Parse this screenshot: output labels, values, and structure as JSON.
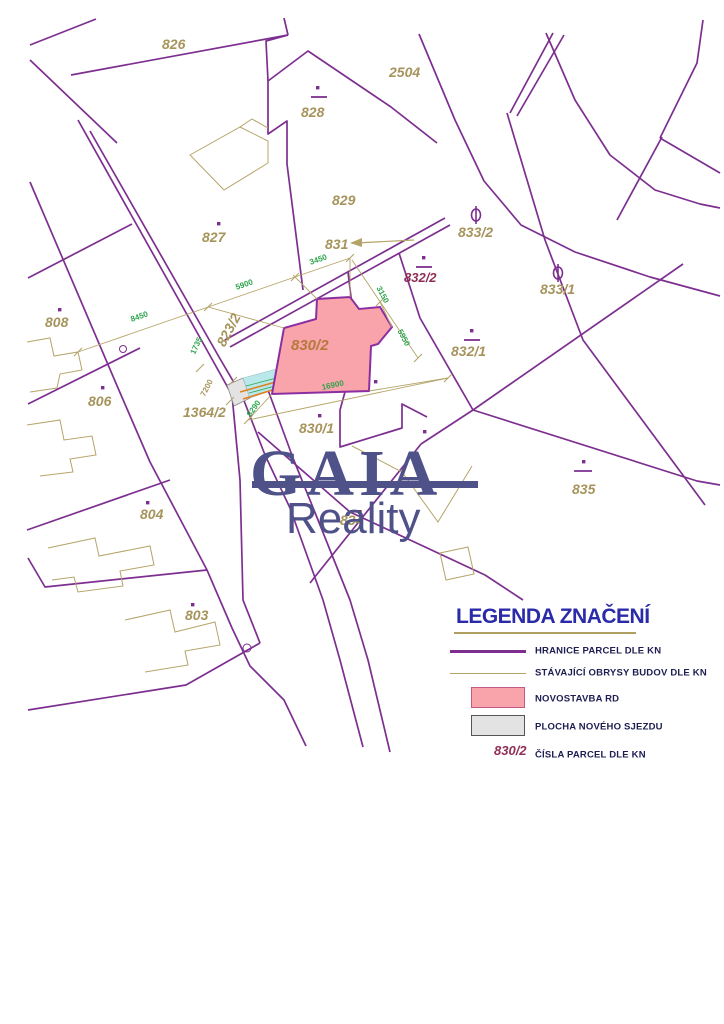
{
  "map": {
    "labels": [
      {
        "text": "826"
      },
      {
        "text": "2504"
      },
      {
        "text": "828"
      },
      {
        "text": "827"
      },
      {
        "text": "829"
      },
      {
        "text": "831"
      },
      {
        "text": "833/2"
      },
      {
        "text": "833/1"
      },
      {
        "text": "832/2"
      },
      {
        "text": "832/1"
      },
      {
        "text": "808"
      },
      {
        "text": "806"
      },
      {
        "text": "823/2"
      },
      {
        "text": "1364/2"
      },
      {
        "text": "830/2"
      },
      {
        "text": "830/1"
      },
      {
        "text": "834"
      },
      {
        "text": "835"
      },
      {
        "text": "804"
      },
      {
        "text": "803"
      }
    ],
    "dims": [
      {
        "text": "8450"
      },
      {
        "text": "5900"
      },
      {
        "text": "3450"
      },
      {
        "text": "3150"
      },
      {
        "text": "5950"
      },
      {
        "text": "16900"
      },
      {
        "text": "8290"
      },
      {
        "text": "7200"
      },
      {
        "text": "1735"
      }
    ]
  },
  "logo": {
    "title": "GAIA",
    "subtitle": "Reality"
  },
  "legend": {
    "title": "LEGENDA ZNAČENÍ",
    "items": [
      {
        "label": "HRANICE PARCEL DLE KN"
      },
      {
        "label": "STÁVAJÍCÍ OBRYSY BUDOV DLE KN"
      },
      {
        "label": "NOVOSTAVBA RD"
      },
      {
        "label": "PLOCHA NOVÉHO SJEZDU"
      },
      {
        "label": "ČÍSLA PARCEL DLE KN",
        "sample": "830/2"
      }
    ]
  },
  "colors": {
    "parcel_boundary": "#7d2f8f",
    "building_outline": "#b5a468",
    "parcel_label": "#a6945c",
    "dimension_text": "#2fa44e",
    "highlight_parcel_number": "#8f2f55",
    "novostavba_fill": "#f9a3ab",
    "sjezd_fill": "#e3e3e3",
    "sjezd_band": "#b8e8ea",
    "sjezd_stripe": "#e08020",
    "logo": "#4e5289",
    "legend_title": "#2b2baa"
  }
}
